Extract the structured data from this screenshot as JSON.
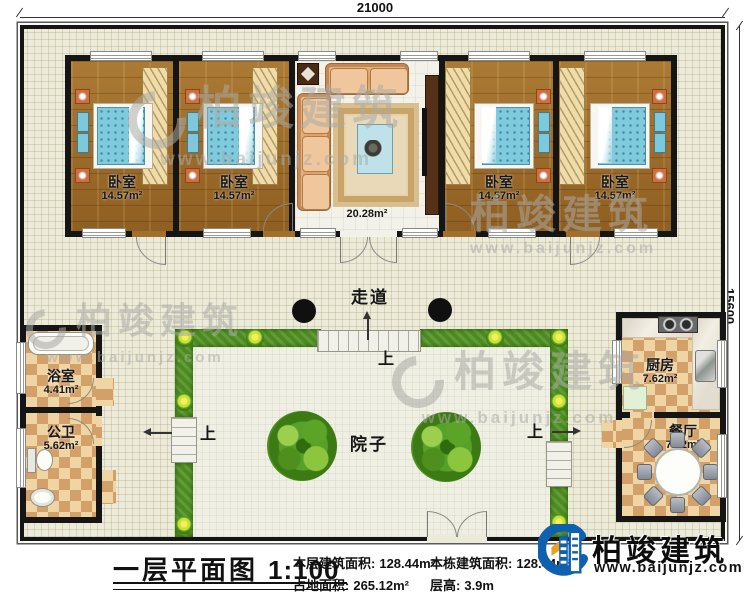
{
  "dimensions": {
    "width_top": "21000",
    "height_right": "15600"
  },
  "labels": {
    "corridor": "走道",
    "yard": "院子",
    "stairs_up": "上"
  },
  "rooms": [
    {
      "id": "bedroom-1",
      "name": "卧室",
      "area": "14.57m²"
    },
    {
      "id": "bedroom-2",
      "name": "卧室",
      "area": "14.57m²"
    },
    {
      "id": "living-room",
      "name": "客厅",
      "area": "20.28m²"
    },
    {
      "id": "bedroom-3",
      "name": "卧室",
      "area": "14.57m²"
    },
    {
      "id": "bedroom-4",
      "name": "卧室",
      "area": "14.57m²"
    },
    {
      "id": "bathroom",
      "name": "浴室",
      "area": "4.41m²"
    },
    {
      "id": "toilet",
      "name": "公卫",
      "area": "5.62m²"
    },
    {
      "id": "kitchen",
      "name": "厨房",
      "area": "7.62m²"
    },
    {
      "id": "dining-room",
      "name": "餐厅",
      "area": "7.62m²"
    }
  ],
  "footer": {
    "title": "一层平面图",
    "scale": "1:100",
    "stats": [
      {
        "label": "本层建筑面积:",
        "value": "128.44m²"
      },
      {
        "label": "占地面积:",
        "value": "265.12m²"
      },
      {
        "label": "本栋建筑面积:",
        "value": "128.44m²"
      },
      {
        "label": "层高:",
        "value": "3.9m"
      }
    ]
  },
  "brand": {
    "name": "柏竣建筑",
    "website": "www.baijunjz.com"
  },
  "watermark": {
    "name": "柏竣建筑",
    "website": "www.baijunjz.com"
  },
  "colors": {
    "wall": "#151515",
    "hedge": "#4c8c1f",
    "wood_floor": "#a0702c",
    "bed": "#80cade",
    "checker": "#d3a06a",
    "brand_blue": "#1060b0"
  }
}
